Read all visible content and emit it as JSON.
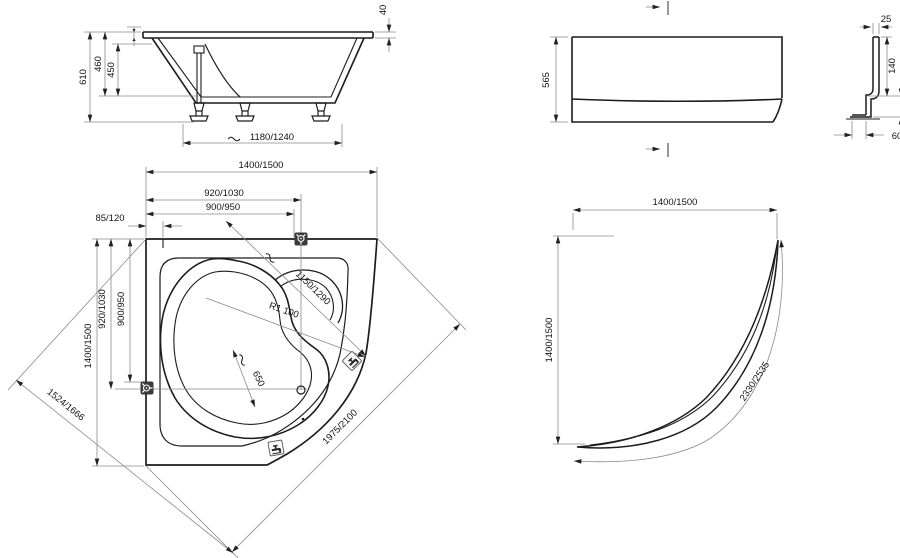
{
  "side_view": {
    "height_total": "610",
    "height_to_floor": "460",
    "inner_depth": "450",
    "rim_height": "40",
    "feet_spacing": "1180/1240"
  },
  "plan_view": {
    "width": "1400/1500",
    "width_to_drain": "920/1030",
    "width_to_tap": "900/950",
    "corner_offset": "85/120",
    "length": "1400/1500",
    "length_to_drain": "920/1030",
    "length_to_tap": "900/950",
    "inner_diagonal": "1150/1290",
    "front_radius": "R1 100",
    "seat_width": "650",
    "front_edge": "1975/2100",
    "diagonal_width": "1524/1666"
  },
  "panel_front_view": {
    "height": "565"
  },
  "panel_profile": {
    "top_width": "25",
    "upper_height": "140",
    "lower_height": "150",
    "foot_offset": "60"
  },
  "panel_plan_view": {
    "width": "1400/1500",
    "length": "1400/1500",
    "arc_length": "2330/2535"
  },
  "icons": {
    "wall_mixer": "wall-mixer-icon",
    "deck_tap": "deck-tap-icon",
    "approx_wave": "approx-wave-icon"
  },
  "colors": {
    "line": "#1c1c1c",
    "dimension_line": "#8a8a8a",
    "icon_dark_fill": "#3a3a3a",
    "background": "#ffffff"
  }
}
